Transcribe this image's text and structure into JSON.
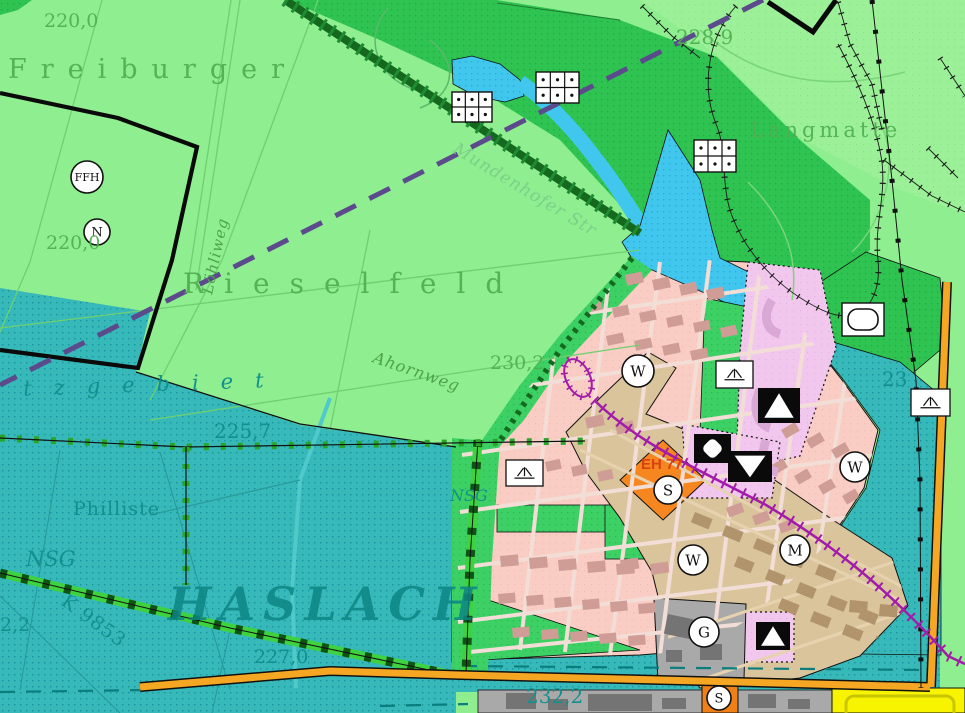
{
  "map": {
    "title": "Flächennutzungsplan-Ausschnitt Freiburg (Rieselfeld / Haslach)",
    "colors": {
      "field_green": "#8fee8f",
      "forest_green": "#2fc351",
      "park_green": "#3dd165",
      "water_cyan": "#41c7ee",
      "reserve_teal": "#38b9b9",
      "residential_pink": "#f9cdc4",
      "mixed_tan": "#d9c49c",
      "special_violet": "#f2c7ee",
      "commercial_orange": "#f6861f",
      "road_orange": "#f5a623",
      "industry_yellow": "#f8f400",
      "public_gray": "#a9a9a9",
      "tram_magenta": "#a21caa",
      "planning_purple": "#5b4a8c",
      "label_green": "#4fb051",
      "label_teal": "#12908e"
    },
    "labels": [
      {
        "id": "elev-220a",
        "text": "220,0",
        "x": 44,
        "y": 27,
        "size": 19,
        "ls": 0,
        "rot": 0,
        "cls": "green"
      },
      {
        "id": "freiburger",
        "text": "Freiburger",
        "x": 8,
        "y": 78,
        "size": 27,
        "ls": 14,
        "rot": 0,
        "cls": "green"
      },
      {
        "id": "elev-228-9",
        "text": "228,9",
        "x": 676,
        "y": 44,
        "size": 20,
        "ls": 0,
        "rot": 0,
        "cls": "green"
      },
      {
        "id": "langmatte",
        "text": "Langmatte",
        "x": 750,
        "y": 137,
        "size": 21,
        "ls": 4,
        "rot": 0,
        "cls": "green"
      },
      {
        "id": "elev-220b",
        "text": "220,0",
        "x": 46,
        "y": 249,
        "size": 19,
        "ls": 0,
        "rot": 0,
        "cls": "green"
      },
      {
        "id": "rieselfeld",
        "text": "Rieselfeld",
        "x": 183,
        "y": 293,
        "size": 28,
        "ls": 20,
        "rot": 0,
        "cls": "green"
      },
      {
        "id": "loehliweg",
        "text": "Löhliweg",
        "x": 212,
        "y": 295,
        "size": 15,
        "ls": 1,
        "rot": -78,
        "cls": "street"
      },
      {
        "id": "mundenhofer-str",
        "text": "Mundenhofer Str",
        "x": 452,
        "y": 152,
        "size": 17,
        "ls": 1,
        "rot": 31,
        "cls": "street-pale"
      },
      {
        "id": "ahornweg",
        "text": "Ahornweg",
        "x": 372,
        "y": 362,
        "size": 16,
        "ls": 1,
        "rot": 19,
        "cls": "street"
      },
      {
        "id": "elev-230-2",
        "text": "230,2",
        "x": 490,
        "y": 369,
        "size": 19,
        "ls": 0,
        "rot": 0,
        "cls": "green"
      },
      {
        "id": "schutzgebiet",
        "text": "utzgebiet",
        "x": -12,
        "y": 397,
        "size": 21,
        "ls": 22,
        "rot": -2,
        "cls": "teal-italic"
      },
      {
        "id": "elev-225-7",
        "text": "225,7",
        "x": 214,
        "y": 438,
        "size": 20,
        "ls": 0,
        "rot": 0,
        "cls": "teal"
      },
      {
        "id": "nsg-a",
        "text": "NSG",
        "x": 450,
        "y": 501,
        "size": 16,
        "ls": 0,
        "rot": 0,
        "cls": "teal-italic"
      },
      {
        "id": "nsg-b",
        "text": "NSG",
        "x": 26,
        "y": 566,
        "size": 21,
        "ls": 0,
        "rot": 0,
        "cls": "teal-italic"
      },
      {
        "id": "philliste",
        "text": "Philliste",
        "x": 73,
        "y": 515,
        "size": 19,
        "ls": 1,
        "rot": 0,
        "cls": "teal-serif"
      },
      {
        "id": "haslach",
        "text": "HASLACH",
        "x": 168,
        "y": 620,
        "size": 46,
        "ls": 8,
        "rot": 0,
        "cls": "teal-big"
      },
      {
        "id": "k9853",
        "text": "K 9853",
        "x": 60,
        "y": 604,
        "size": 19,
        "ls": 1,
        "rot": 36,
        "cls": "teal"
      },
      {
        "id": "elev-227-0",
        "text": "227,0",
        "x": 254,
        "y": 663,
        "size": 19,
        "ls": 0,
        "rot": 0,
        "cls": "teal"
      },
      {
        "id": "elev-2-2",
        "text": "2,2",
        "x": 0,
        "y": 631,
        "size": 19,
        "ls": 0,
        "rot": 0,
        "cls": "teal"
      },
      {
        "id": "elev-232-2",
        "text": "232,2",
        "x": 526,
        "y": 703,
        "size": 20,
        "ls": 0,
        "rot": 0,
        "cls": "teal"
      },
      {
        "id": "elev-23",
        "text": "23",
        "x": 882,
        "y": 386,
        "size": 20,
        "ls": 0,
        "rot": 0,
        "cls": "teal"
      },
      {
        "id": "eh77",
        "text": "EH 77",
        "x": 641,
        "y": 469,
        "size": 15,
        "ls": 0,
        "rot": 0,
        "cls": "eh"
      }
    ],
    "zone_markers": [
      {
        "id": "ffh",
        "letter": "FFH",
        "x": 87,
        "y": 177,
        "r": 16,
        "fs": 11
      },
      {
        "id": "n",
        "letter": "N",
        "x": 97,
        "y": 232,
        "r": 13,
        "fs": 13
      },
      {
        "id": "w1",
        "letter": "W",
        "x": 638,
        "y": 371,
        "r": 16,
        "fs": 15
      },
      {
        "id": "w2",
        "letter": "W",
        "x": 855,
        "y": 467,
        "r": 15,
        "fs": 15
      },
      {
        "id": "w3",
        "letter": "W",
        "x": 693,
        "y": 560,
        "r": 15,
        "fs": 15
      },
      {
        "id": "m",
        "letter": "M",
        "x": 795,
        "y": 550,
        "r": 15,
        "fs": 15
      },
      {
        "id": "g",
        "letter": "G",
        "x": 704,
        "y": 632,
        "r": 15,
        "fs": 15
      },
      {
        "id": "s1",
        "letter": "S",
        "x": 668,
        "y": 490,
        "r": 14,
        "fs": 15
      },
      {
        "id": "s2",
        "letter": "S",
        "x": 719,
        "y": 698,
        "r": 12,
        "fs": 13
      }
    ],
    "symbols": [
      {
        "type": "allotment-garden",
        "x": 452,
        "y": 92,
        "w": 40,
        "h": 30
      },
      {
        "type": "allotment-garden",
        "x": 536,
        "y": 72,
        "w": 43,
        "h": 31
      },
      {
        "type": "allotment-garden",
        "x": 694,
        "y": 140,
        "w": 42,
        "h": 32
      },
      {
        "type": "grassland",
        "x": 506,
        "y": 460,
        "w": 37,
        "h": 26
      },
      {
        "type": "grassland",
        "x": 716,
        "y": 361,
        "w": 37,
        "h": 27
      },
      {
        "type": "grassland",
        "x": 911,
        "y": 389,
        "w": 39,
        "h": 27
      },
      {
        "type": "sports-field",
        "x": 842,
        "y": 303,
        "w": 42,
        "h": 33
      },
      {
        "type": "camp-site",
        "x": 758,
        "y": 388,
        "w": 42,
        "h": 35
      },
      {
        "type": "camp-site",
        "x": 756,
        "y": 622,
        "w": 34,
        "h": 28
      },
      {
        "type": "triangle-down",
        "x": 728,
        "y": 451,
        "w": 44,
        "h": 31
      },
      {
        "type": "quatrefoil",
        "x": 694,
        "y": 434,
        "w": 37,
        "h": 29
      }
    ]
  }
}
